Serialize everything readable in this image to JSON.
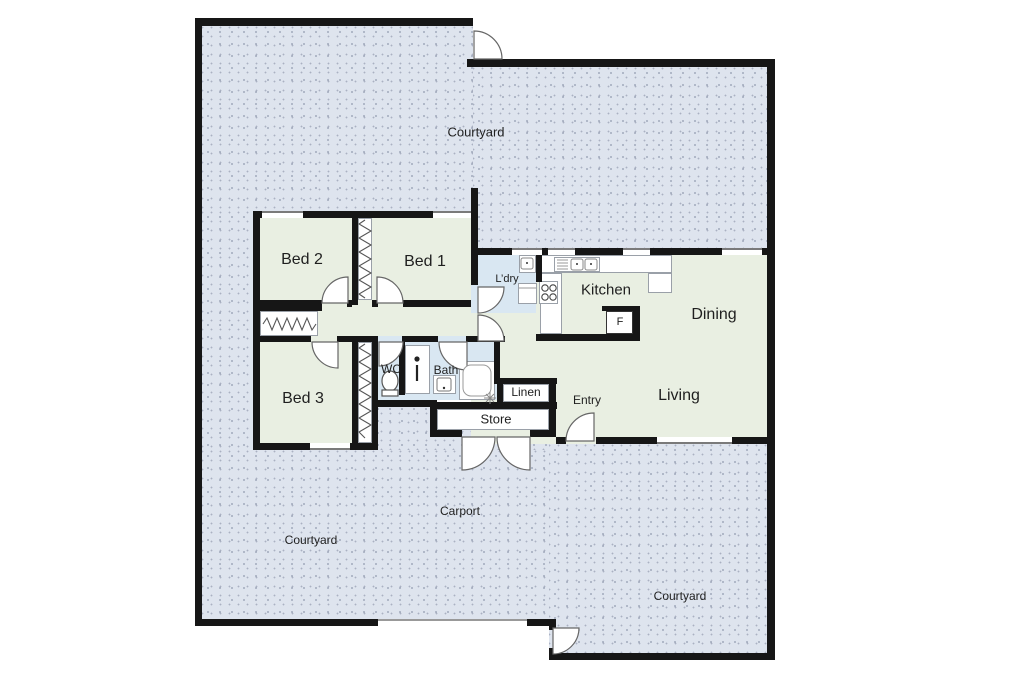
{
  "rooms": {
    "courtyard_top": {
      "label": "Courtyard"
    },
    "bed2": {
      "label": "Bed 2"
    },
    "bed1": {
      "label": "Bed 1"
    },
    "laundry": {
      "label": "L’dry"
    },
    "kitchen": {
      "label": "Kitchen"
    },
    "dining": {
      "label": "Dining"
    },
    "bed3": {
      "label": "Bed 3"
    },
    "wc": {
      "label": "WC"
    },
    "bath": {
      "label": "Bath"
    },
    "linen": {
      "label": "Linen"
    },
    "entry": {
      "label": "Entry"
    },
    "living": {
      "label": "Living"
    },
    "store": {
      "label": "Store"
    },
    "carport": {
      "label": "Carport"
    },
    "courtyard_bottom_left": {
      "label": "Courtyard"
    },
    "courtyard_bottom_right": {
      "label": "Courtyard"
    }
  },
  "fixtures": {
    "fridge": {
      "label": "F"
    },
    "icons": [
      "toilet-icon",
      "shower-icon",
      "vanity-basin-icon",
      "bathtub-icon",
      "tap-sparkle-icon",
      "kitchen-sink-icon",
      "cooktop-icon",
      "laundry-tub-icon",
      "washing-machine-icon",
      "wardrobe-zigzag-icon",
      "door-swing-icon",
      "window-icon"
    ]
  },
  "colors": {
    "wall": "#161616",
    "courtyard_fill": "#dee4ee",
    "room_fill": "#e9efe2",
    "wet_area_fill": "#d9e7f2",
    "fixture_outline": "#9aa0a8"
  }
}
